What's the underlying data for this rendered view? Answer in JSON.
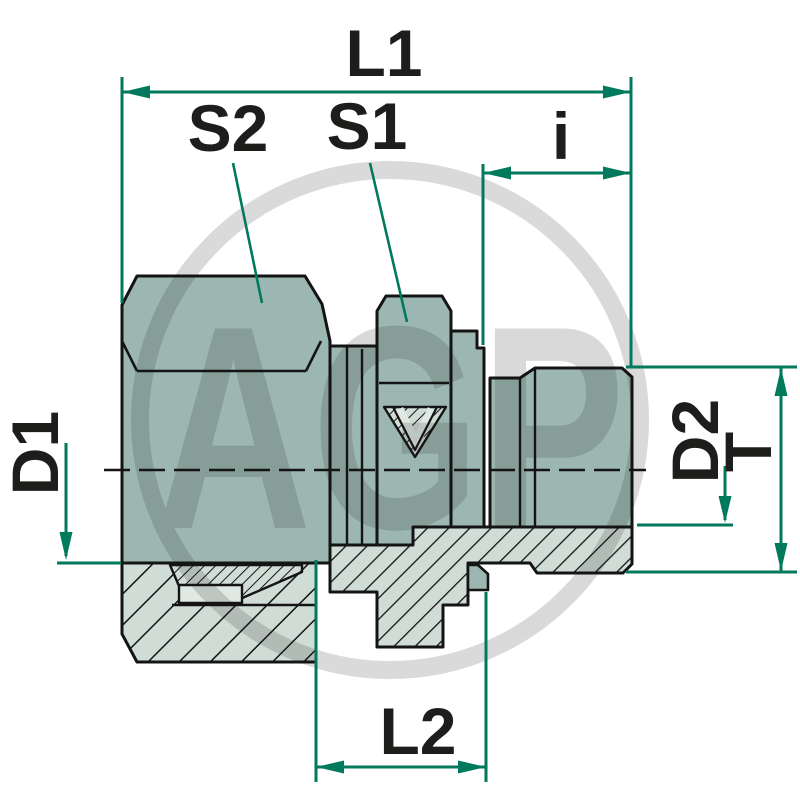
{
  "drawing": {
    "watermark": "AGP",
    "dimension_labels": {
      "l1": "L1",
      "s2": "S2",
      "s1": "S1",
      "i": "i",
      "d1": "D1",
      "d2": "D2",
      "t": "T",
      "l2": "L2"
    },
    "colors": {
      "body_fill": "#9cb7b1",
      "section_fill": "#d0dcd6",
      "detail_fill": "#dfe8e3",
      "outline": "#141414",
      "dimension_line": "#00795c",
      "label_text": "#1d1d1b",
      "watermark": "#d6d6d6",
      "background": "#ffffff"
    }
  }
}
